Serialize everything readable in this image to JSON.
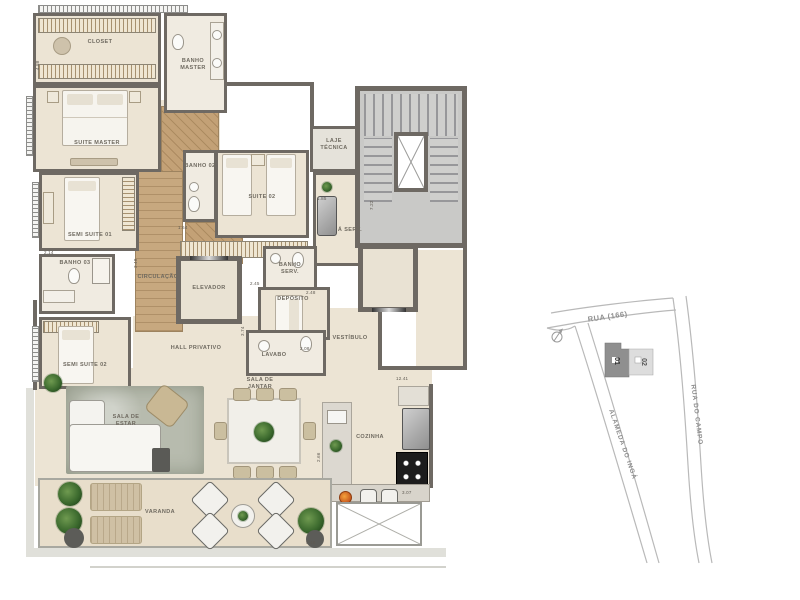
{
  "plan": {
    "rooms": {
      "closet": "CLOSET",
      "banho_master": "BANHO MASTER",
      "suite_master": "SUITE MASTER",
      "semi_suite_01": "SEMI SUITE 01",
      "banho_03": "BANHO 03",
      "semi_suite_02": "SEMI SUITE 02",
      "banho_02": "BANHO 02",
      "suite_02": "SUITE 02",
      "laje_tecnica": "LAJE TÉCNICA",
      "a_serv": "Á SERV.",
      "circulacao": "CIRCULAÇÃO",
      "elevador": "ELEVADOR",
      "banho_serv": "BANHO SERV.",
      "deposito": "DEPÓSITO",
      "lavabo": "LAVABO",
      "hall_privativo": "HALL PRIVATIVO",
      "vestibulo": "VESTÍBULO",
      "sala_jantar": "SALA DE JANTAR",
      "sala_estar": "SALA DE ESTAR",
      "cozinha": "COZINHA",
      "varanda": "VARANDA"
    },
    "dims": {
      "d1": "4.88",
      "d2": "2.14",
      "d3": "3.48",
      "d4": "1.64",
      "d5": "1.85",
      "d6": "7.22",
      "d7": "2.45",
      "d8": "2.48",
      "d9": "3.74",
      "d10": "2.08",
      "d11": "12.41",
      "d12": "2.66",
      "d13": "3.07",
      "d14": "9.48"
    }
  },
  "map": {
    "street_top": "RUA (166)",
    "street_right": "RUA DO CAMPO",
    "street_left": "ALAMEDA DO INGÁ",
    "unit_01": "01",
    "unit_02": "02"
  },
  "colors": {
    "wall": "#6e6963",
    "floor": "#ece4d4",
    "wood": "#c7a87f",
    "rug": "#b7bbae",
    "stairs": "#c9c9c7",
    "map_line": "#b9b9b9",
    "unit_01_fill": "#8f8f8f",
    "unit_02_fill": "#dddddd"
  }
}
